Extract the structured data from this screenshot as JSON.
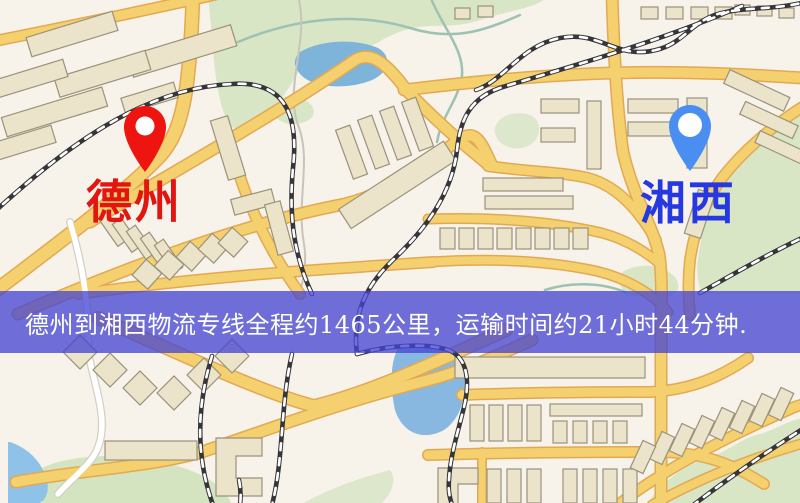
{
  "map": {
    "type": "static-city-map",
    "colors": {
      "background": "#f7f2ea",
      "road_fill": "#f5d06e",
      "road_casing": "#e2a952",
      "minor_road": "#ffffff",
      "building_fill": "#ebe3ca",
      "building_stroke": "#9a927a",
      "green_area": "#d8e6c6",
      "water": "#7eb3da",
      "railway_dark": "#35353a",
      "railway_dash": "#ffffff",
      "stream": "#9ec2b2"
    }
  },
  "markers": {
    "origin": {
      "label": "德州",
      "label_color": "#e21511",
      "pin_color": "#ee1511",
      "icon": "map-pin-icon"
    },
    "destination": {
      "label": "湘西",
      "label_color": "#2638df",
      "pin_color": "#4b8ef2",
      "icon": "map-pin-icon"
    }
  },
  "banner": {
    "text": "德州到湘西物流专线全程约1465公里，运输时间约21小时44分钟.",
    "background": "rgba(68,68,212,0.76)",
    "text_color": "#ffffff"
  },
  "route": {
    "origin": "德州",
    "destination": "湘西",
    "distance_text": "约1465公里",
    "duration_text": "约21小时44分钟"
  }
}
